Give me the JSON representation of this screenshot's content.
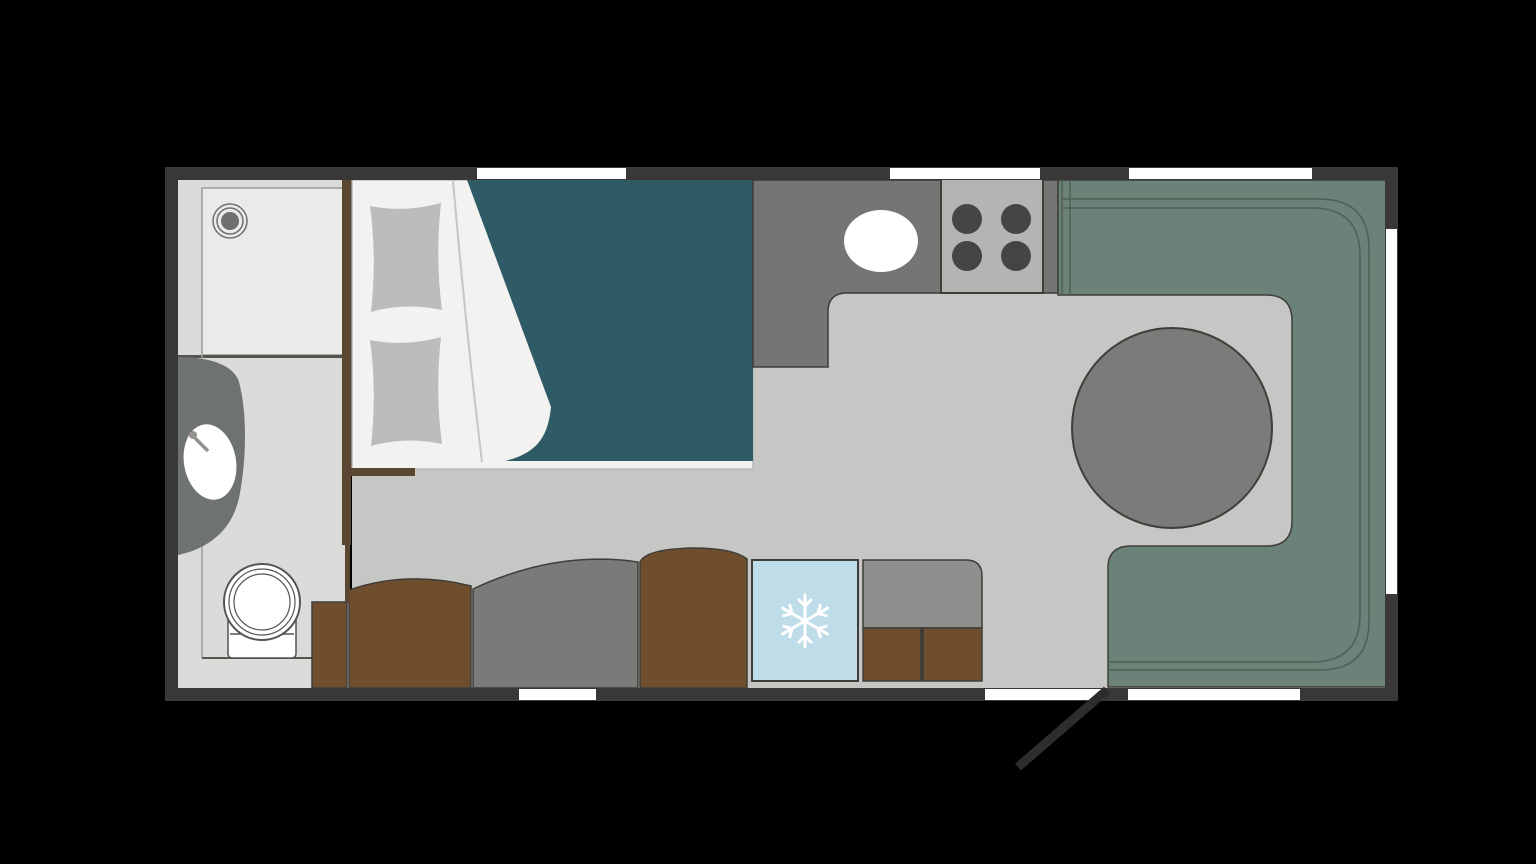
{
  "meta": {
    "type": "caravan-floor-plan",
    "description": "Top-down floor plan of a caravan interior on black background"
  },
  "colors": {
    "background": "#000000",
    "wall": "#3a3836",
    "window": "#ffffff",
    "floor": "#c6c6c4",
    "bathroom_floor": "#dbdbd9",
    "shower_tray": "#eaeae8",
    "fixture_white": "#ffffff",
    "vanity": "#6e7270",
    "drain": "#6f6f6d",
    "bed_sheet": "#f2f2f0",
    "pillow": "#bcbcba",
    "duvet": "#2f5b67",
    "wood_wall": "#5a4631",
    "counter": "#757573",
    "hob": "#b4b4b2",
    "burner": "#454543",
    "cushion_brown": "#6f4e2e",
    "cushion_gray": "#7a7a78",
    "fridge": "#bfdde8",
    "snowflake": "#ffffff",
    "wardrobe": "#8f8f8d",
    "wardrobe_door": "#6f4e2e",
    "dinette": "#6a8277",
    "seat_outline": "#4f5f57",
    "table": "#7b7b79",
    "outline": "#3f3d3a",
    "bath_line": "#55534f",
    "door_swing": "#2d2d2b"
  },
  "items": [
    "shower",
    "washbasin",
    "toilet",
    "double-bed",
    "pillows",
    "duvet",
    "wardrobe-partition",
    "kitchen-counter",
    "kitchen-sink",
    "hob",
    "bench-seat-cushions",
    "refrigerator",
    "wardrobe",
    "dinette-seating",
    "round-table",
    "entrance-door",
    "windows"
  ]
}
